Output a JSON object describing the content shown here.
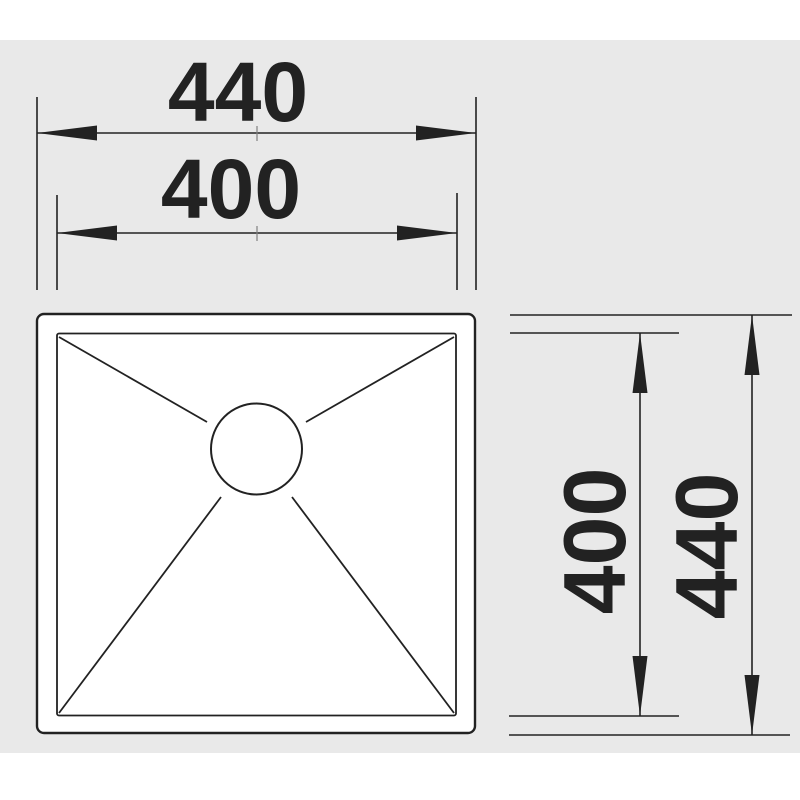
{
  "drawing": {
    "type": "technical-dimension-diagram",
    "subject": "square sink top view with drain",
    "labels": {
      "width_outer": "440",
      "width_inner": "400",
      "height_inner": "400",
      "height_outer": "440"
    },
    "colors": {
      "canvas": "#e9e9e9",
      "line": "#222222",
      "surface": "#ffffff",
      "tick": "#808080"
    }
  }
}
